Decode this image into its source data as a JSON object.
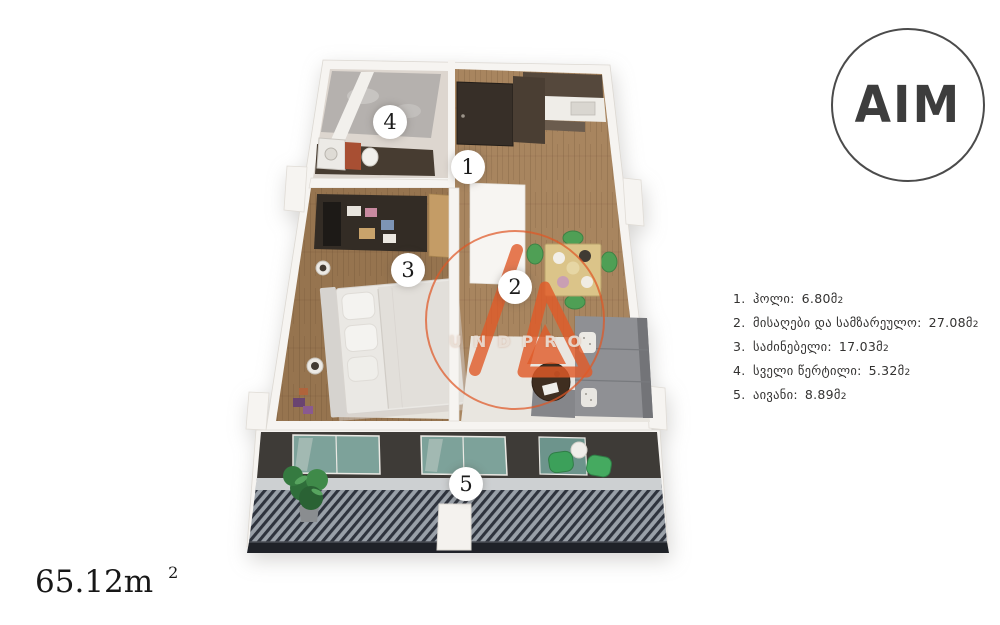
{
  "brand": {
    "logo_text": "AIM"
  },
  "watermark": {
    "text": "UNDPRO"
  },
  "total_area": {
    "value": "65.12m",
    "sup": "2"
  },
  "plan": {
    "room_badges": [
      {
        "number": "1"
      },
      {
        "number": "2"
      },
      {
        "number": "3"
      },
      {
        "number": "4"
      },
      {
        "number": "5"
      }
    ]
  },
  "legend": {
    "items": [
      {
        "number": "1.",
        "name": "ჰოლი:",
        "area": "6.80მ",
        "sup": "2"
      },
      {
        "number": "2.",
        "name": "მისაღები და სამზარეულო:",
        "area": "27.08მ",
        "sup": "2"
      },
      {
        "number": "3.",
        "name": "საძინებელი:",
        "area": "17.03მ",
        "sup": "2"
      },
      {
        "number": "4.",
        "name": "სველი წერტილი:",
        "area": "5.32მ",
        "sup": "2"
      },
      {
        "number": "5.",
        "name": "აივანი:",
        "area": "8.89მ",
        "sup": "2"
      }
    ]
  }
}
